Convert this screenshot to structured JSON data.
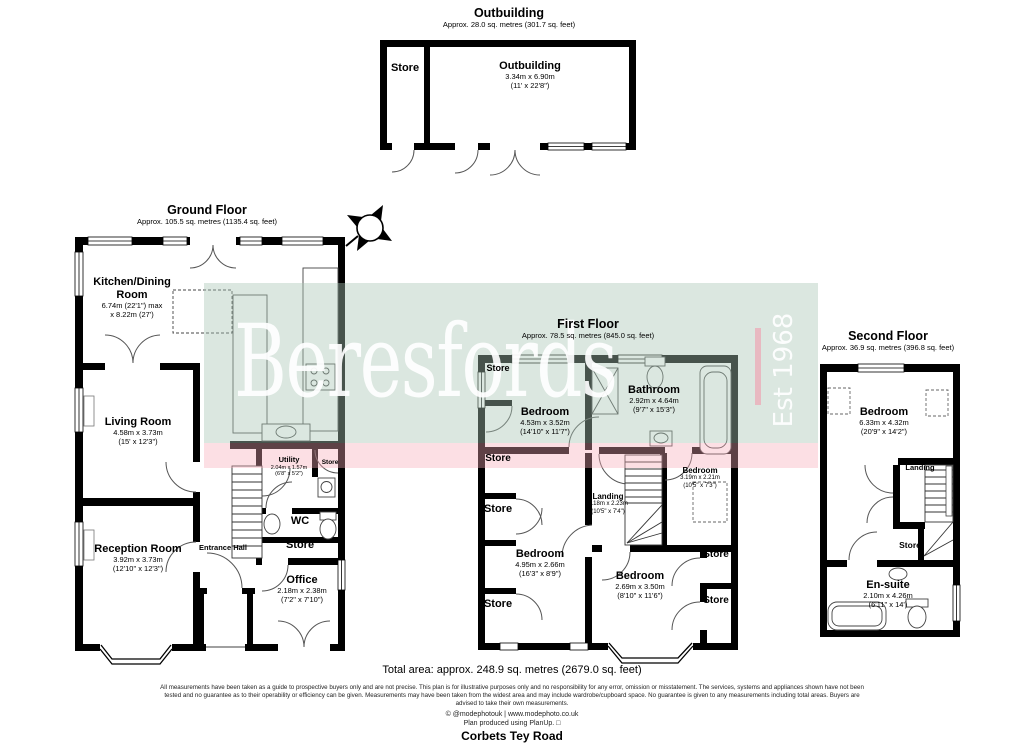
{
  "watermark": {
    "brand": "Beresfords",
    "est": "Est 1968",
    "colors": {
      "band_green": "#dfe9e2",
      "band_pink": "#fbdee2",
      "accent_pink": "#f29cb0",
      "wall": "#000000"
    }
  },
  "common": {
    "store": "Store"
  },
  "outbuilding": {
    "title": "Outbuilding",
    "area": "Approx. 28.0 sq. metres (301.7 sq. feet)",
    "room": {
      "name": "Outbuilding",
      "dim1": "3.34m x 6.90m",
      "dim2": "(11' x 22'8\")"
    }
  },
  "ground": {
    "title": "Ground Floor",
    "area": "Approx. 105.5 sq. metres (1135.4 sq. feet)",
    "kitchen": {
      "name": "Kitchen/Dining Room",
      "dim1": "6.74m (22'1\") max",
      "dim2": "x 8.22m (27')"
    },
    "living": {
      "name": "Living Room",
      "dim1": "4.58m x 3.73m",
      "dim2": "(15' x 12'3\")"
    },
    "reception": {
      "name": "Reception Room",
      "dim1": "3.92m x 3.73m",
      "dim2": "(12'10\" x 12'3\")"
    },
    "office": {
      "name": "Office",
      "dim1": "2.18m x 2.38m",
      "dim2": "(7'2\" x 7'10\")"
    },
    "utility": {
      "name": "Utility",
      "dim1": "2.04m x 1.57m",
      "dim2": "(6'8\" x 5'2\")"
    },
    "wc": "WC",
    "entrance_hall": "Entrance Hall"
  },
  "first": {
    "title": "First Floor",
    "area": "Approx. 78.5 sq. metres (845.0 sq. feet)",
    "bed1": {
      "name": "Bedroom",
      "dim1": "4.53m x 3.52m",
      "dim2": "(14'10\" x 11'7\")"
    },
    "bath": {
      "name": "Bathroom",
      "dim1": "2.92m x 4.64m",
      "dim2": "(9'7\" x 15'3\")"
    },
    "bed2": {
      "name": "Bedroom",
      "dim1": "4.95m x 2.66m",
      "dim2": "(16'3\" x 8'9\")"
    },
    "bed3": {
      "name": "Bedroom",
      "dim1": "3.19m x 2.21m",
      "dim2": "(10'5\" x 7'3\")"
    },
    "bed4": {
      "name": "Bedroom",
      "dim1": "2.69m x 3.50m",
      "dim2": "(8'10\" x 11'6\")"
    },
    "landing": {
      "name": "Landing",
      "dim1": "3.18m x 2.23m",
      "dim2": "(10'5\" x 7'4\")"
    }
  },
  "second": {
    "title": "Second Floor",
    "area": "Approx. 36.9 sq. metres (396.8 sq. feet)",
    "bed": {
      "name": "Bedroom",
      "dim1": "6.33m x 4.32m",
      "dim2": "(20'9\" x 14'2\")"
    },
    "ensuite": {
      "name": "En-suite",
      "dim1": "2.10m x 4.26m",
      "dim2": "(6'11\" x 14')"
    },
    "landing": "Landing"
  },
  "footer": {
    "total": "Total area: approx. 248.9 sq. metres (2679.0 sq. feet)",
    "disc1": "All measurements have been taken as a guide to prospective buyers only and are not precise. This plan is for illustrative purposes only and no responsibility for any error, omission or misstatement. The services, systems and appliances shown have not been",
    "disc2": "tested and no guarantee as to their operability or efficiency can be given. Measurements may have been taken from the widest area and may include wardrobe/cupboard space. No guarantee is given to any measurements including total areas. Buyers are",
    "disc3": "advised to take their own measurements.",
    "credit": "© @modephotouk | www.modephoto.co.uk",
    "produced": "Plan produced using PlanUp. □",
    "address": "Corbets Tey Road"
  }
}
